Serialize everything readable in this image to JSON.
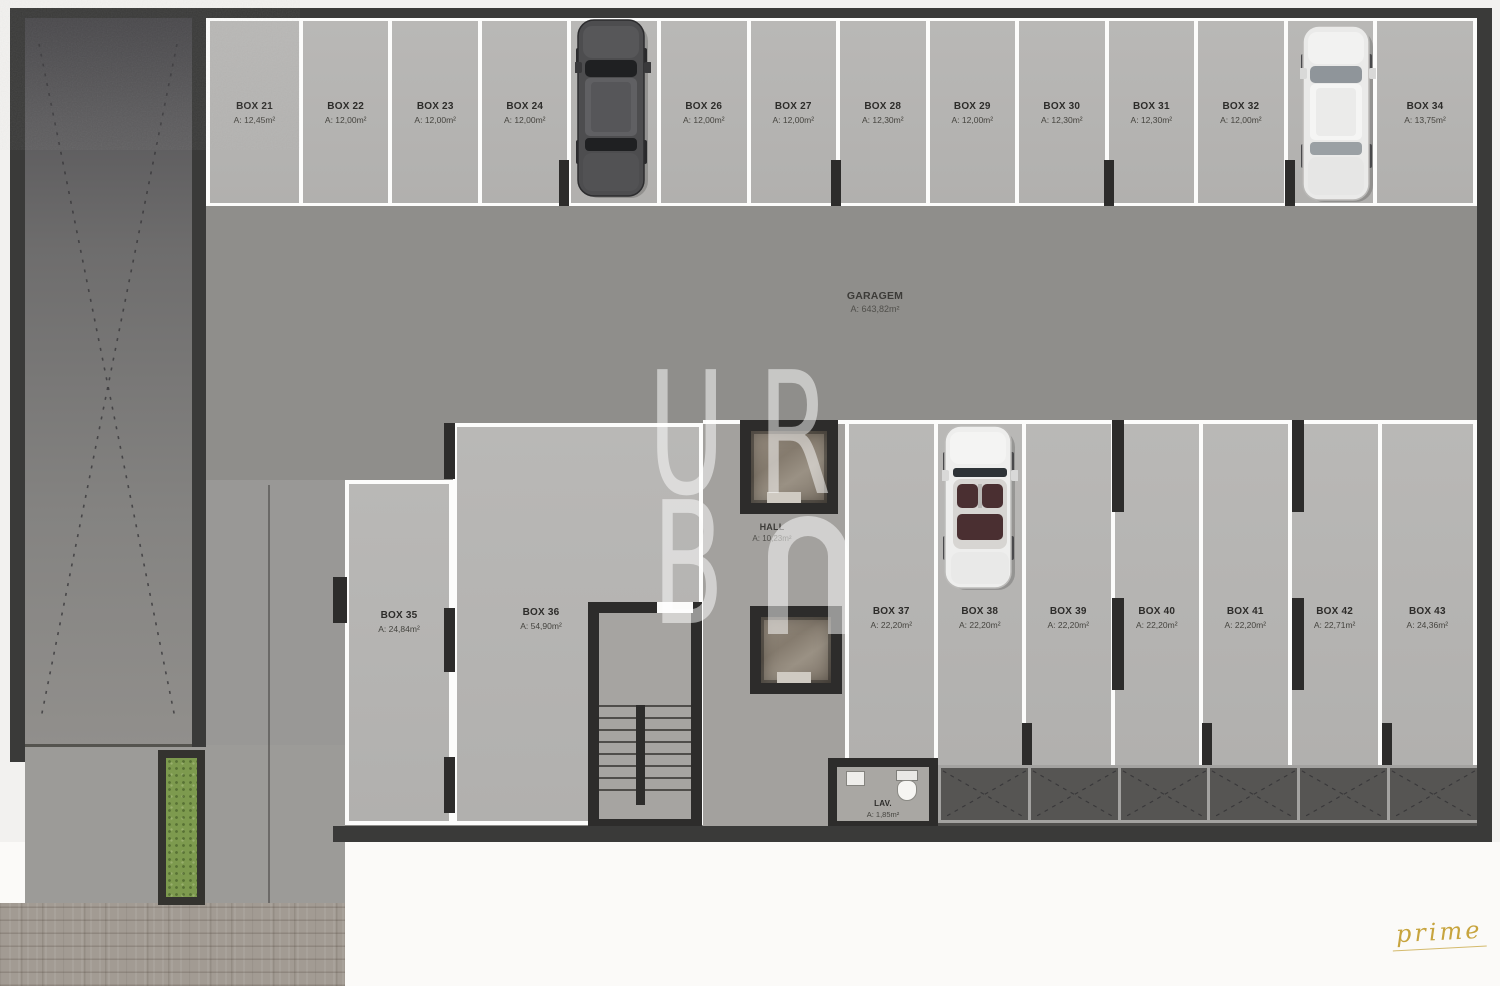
{
  "plan": {
    "garage": {
      "name": "GARAGEM",
      "area": "A: 643,82m²"
    },
    "hall": {
      "name": "HALL",
      "area": "A: 10,23m²"
    },
    "lav": {
      "name": "LAV.",
      "area": "A: 1,85m²"
    },
    "top_boxes": [
      {
        "name": "BOX 21",
        "area": "A: 12,45m²"
      },
      {
        "name": "BOX 22",
        "area": "A: 12,00m²"
      },
      {
        "name": "BOX 23",
        "area": "A: 12,00m²"
      },
      {
        "name": "BOX 24",
        "area": "A: 12,00m²"
      },
      {
        "name": "BOX 25",
        "area": "A: 12,00m²"
      },
      {
        "name": "BOX 26",
        "area": "A: 12,00m²"
      },
      {
        "name": "BOX 27",
        "area": "A: 12,00m²"
      },
      {
        "name": "BOX 28",
        "area": "A: 12,30m²"
      },
      {
        "name": "BOX 29",
        "area": "A: 12,00m²"
      },
      {
        "name": "BOX 30",
        "area": "A: 12,30m²"
      },
      {
        "name": "BOX 31",
        "area": "A: 12,30m²"
      },
      {
        "name": "BOX 32",
        "area": "A: 12,00m²"
      },
      {
        "name": "BOX 33",
        "area": "A: 12,00m²"
      },
      {
        "name": "BOX 34",
        "area": "A: 13,75m²"
      }
    ],
    "mid_boxes": [
      {
        "name": "BOX 35",
        "area": "A: 24,84m²"
      },
      {
        "name": "BOX 36",
        "area": "A: 54,90m²"
      }
    ],
    "bottom_boxes": [
      {
        "name": "BOX 37",
        "area": "A: 22,20m²"
      },
      {
        "name": "BOX 38",
        "area": "A: 22,20m²"
      },
      {
        "name": "BOX 39",
        "area": "A: 22,20m²"
      },
      {
        "name": "BOX 40",
        "area": "A: 22,20m²"
      },
      {
        "name": "BOX 41",
        "area": "A: 22,20m²"
      },
      {
        "name": "BOX 42",
        "area": "A: 22,71m²"
      },
      {
        "name": "BOX 43",
        "area": "A: 24,36m²"
      }
    ]
  },
  "watermark": {
    "l1": "U",
    "l2": "R",
    "l3": "B",
    "arch_symbol": "∩"
  },
  "signature": "prime",
  "colors": {
    "wall": "#3a3a39",
    "box_fill": "#b5b4b1",
    "aisle": "#8f8e8b",
    "hall_floor": "#a3a19e",
    "planter_green": "#7d9a4e",
    "divider_white": "#fcfcfb",
    "signature_gold": "#c7a43e"
  }
}
